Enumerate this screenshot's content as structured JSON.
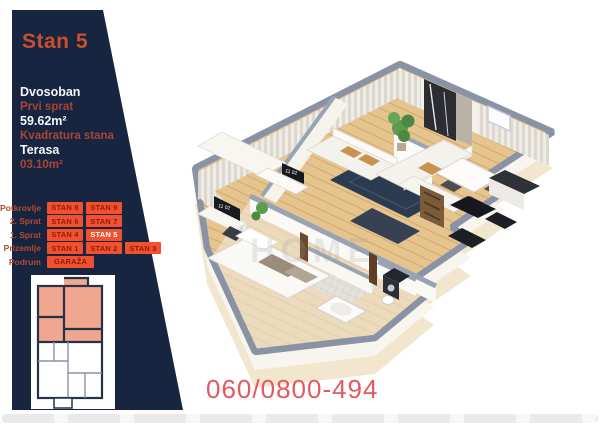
{
  "sidebar": {
    "title": "Stan 5",
    "details": {
      "type": "Dvosoban",
      "floor": "Prvi sprat",
      "area": "59.62m²",
      "area_label": "Kvadratura stana",
      "terrace_label": "Terasa",
      "terrace_area": "03.10m²"
    },
    "floors": [
      {
        "label": "Potkrovlje",
        "units": [
          "STAN 8",
          "STAN 9"
        ]
      },
      {
        "label": "2. Sprat",
        "units": [
          "STAN 6",
          "STAN 7"
        ]
      },
      {
        "label": "1. Sprat",
        "units": [
          "STAN 4",
          "STAN 5"
        ]
      },
      {
        "label": "Prizemlje",
        "units": [
          "STAN 1",
          "STAN 2",
          "STAN 3"
        ]
      },
      {
        "label": "Podrum",
        "units": [
          "GARAŽA"
        ]
      }
    ],
    "active_unit": "STAN 5"
  },
  "floorplan": {
    "tv_clock": "11 02",
    "watermark": "HOME"
  },
  "contact": {
    "phone": "060/0800-494"
  },
  "colors": {
    "sidebar_bg": "#172540",
    "button_orange": "#f1512f",
    "button_text": "#8e1c08",
    "red_label": "#a84534",
    "phone_red": "#e4595f",
    "wall_gray": "#8a93a5",
    "floor_wood": "#e6c48e",
    "foundation_cream": "#f2e6cf",
    "rug_navy": "#2c3b50",
    "highlight_salmon": "#efa78f"
  }
}
